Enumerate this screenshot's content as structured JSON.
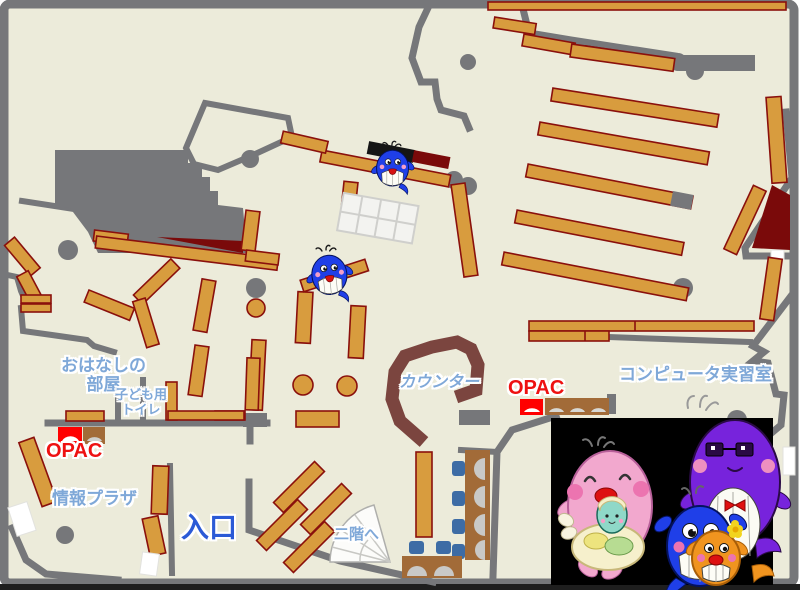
{
  "labels": {
    "storytelling_room": {
      "line1": "おはなしの",
      "line2": "部屋"
    },
    "kids_toilet": {
      "line1": "子ども用",
      "line2": "トイレ"
    },
    "opac_left": "OPAC",
    "info_plaza": "情報プラザ",
    "entrance": "入口",
    "stairs_to_2f": "二階へ",
    "counter": "カウンター",
    "opac_right": "OPAC",
    "computer_room": "コンピュータ実習室"
  },
  "colors": {
    "floor": "#ECEBDA",
    "wall": "#76777A",
    "shelf": "#D89C3E",
    "shelf_border": "#8A100C",
    "dark_red": "#7A0A0A",
    "counter_brown": "#7B453F",
    "desk_brown": "#A26B38",
    "chair_blue": "#3D6CA5",
    "opac_red": "#FF0000",
    "label_blue": "#7FA8D8",
    "label_red": "#EE1111",
    "entrance_blue": "#2B5AD6",
    "mascot_blue": "#1F3FE8",
    "mascot_pink": "#F2A8CE",
    "mascot_purple": "#7723DC",
    "mascot_orange": "#F0941F",
    "mascot_teal": "#8FD8C8"
  },
  "icons": {
    "whale_mascot": "whale-mascot-icon",
    "whale_family_photo": "whale-family-photo"
  }
}
